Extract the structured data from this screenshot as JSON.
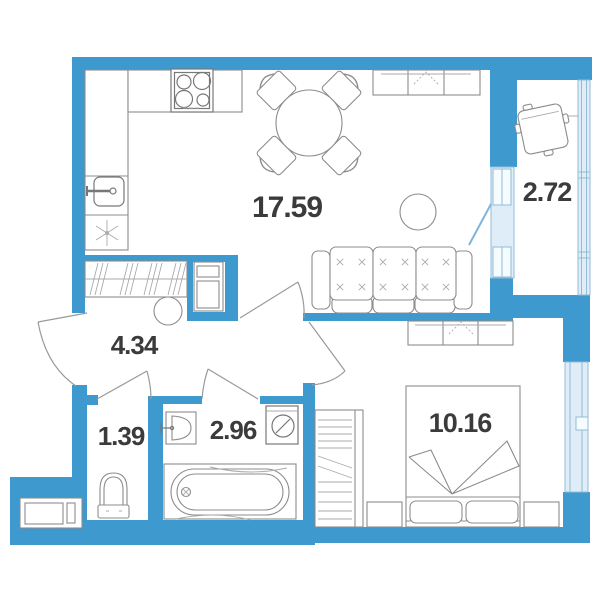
{
  "plan": {
    "title": "Apartment floor plan",
    "colors": {
      "wall": "#3E99CF",
      "glazing_fill": "#DEEDF7",
      "glazing_stroke": "#93BBD4",
      "furniture_stroke": "#8C8C8C",
      "label": "#3B3B3B"
    },
    "rooms": [
      {
        "name": "living-kitchen",
        "area": "17.59"
      },
      {
        "name": "balcony",
        "area": "2.72"
      },
      {
        "name": "hallway",
        "area": "4.34"
      },
      {
        "name": "toilet",
        "area": "1.39"
      },
      {
        "name": "bathroom",
        "area": "2.96"
      },
      {
        "name": "bedroom",
        "area": "10.16"
      }
    ]
  }
}
